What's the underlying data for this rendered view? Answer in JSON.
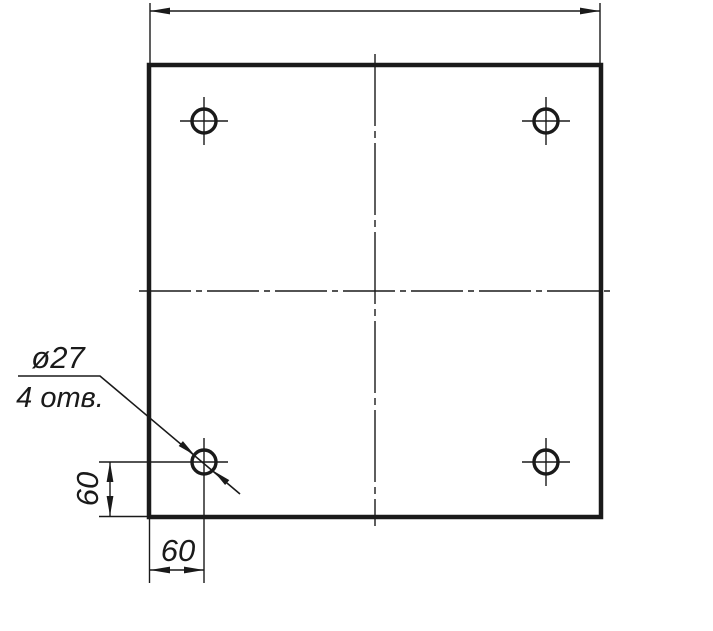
{
  "drawing": {
    "type": "engineering-drawing",
    "colors": {
      "background": "#ffffff",
      "line": "#1a1a1a"
    },
    "annotations": {
      "hole_diameter_label": "ø27",
      "hole_count_label": "4 отв.",
      "dim_vertical_label": "60",
      "dim_horizontal_label": "60"
    },
    "dimensions": {
      "hole_diameter": 27,
      "hole_count": 4,
      "hole_offset_from_left": 60,
      "hole_offset_from_bottom": 60
    }
  }
}
